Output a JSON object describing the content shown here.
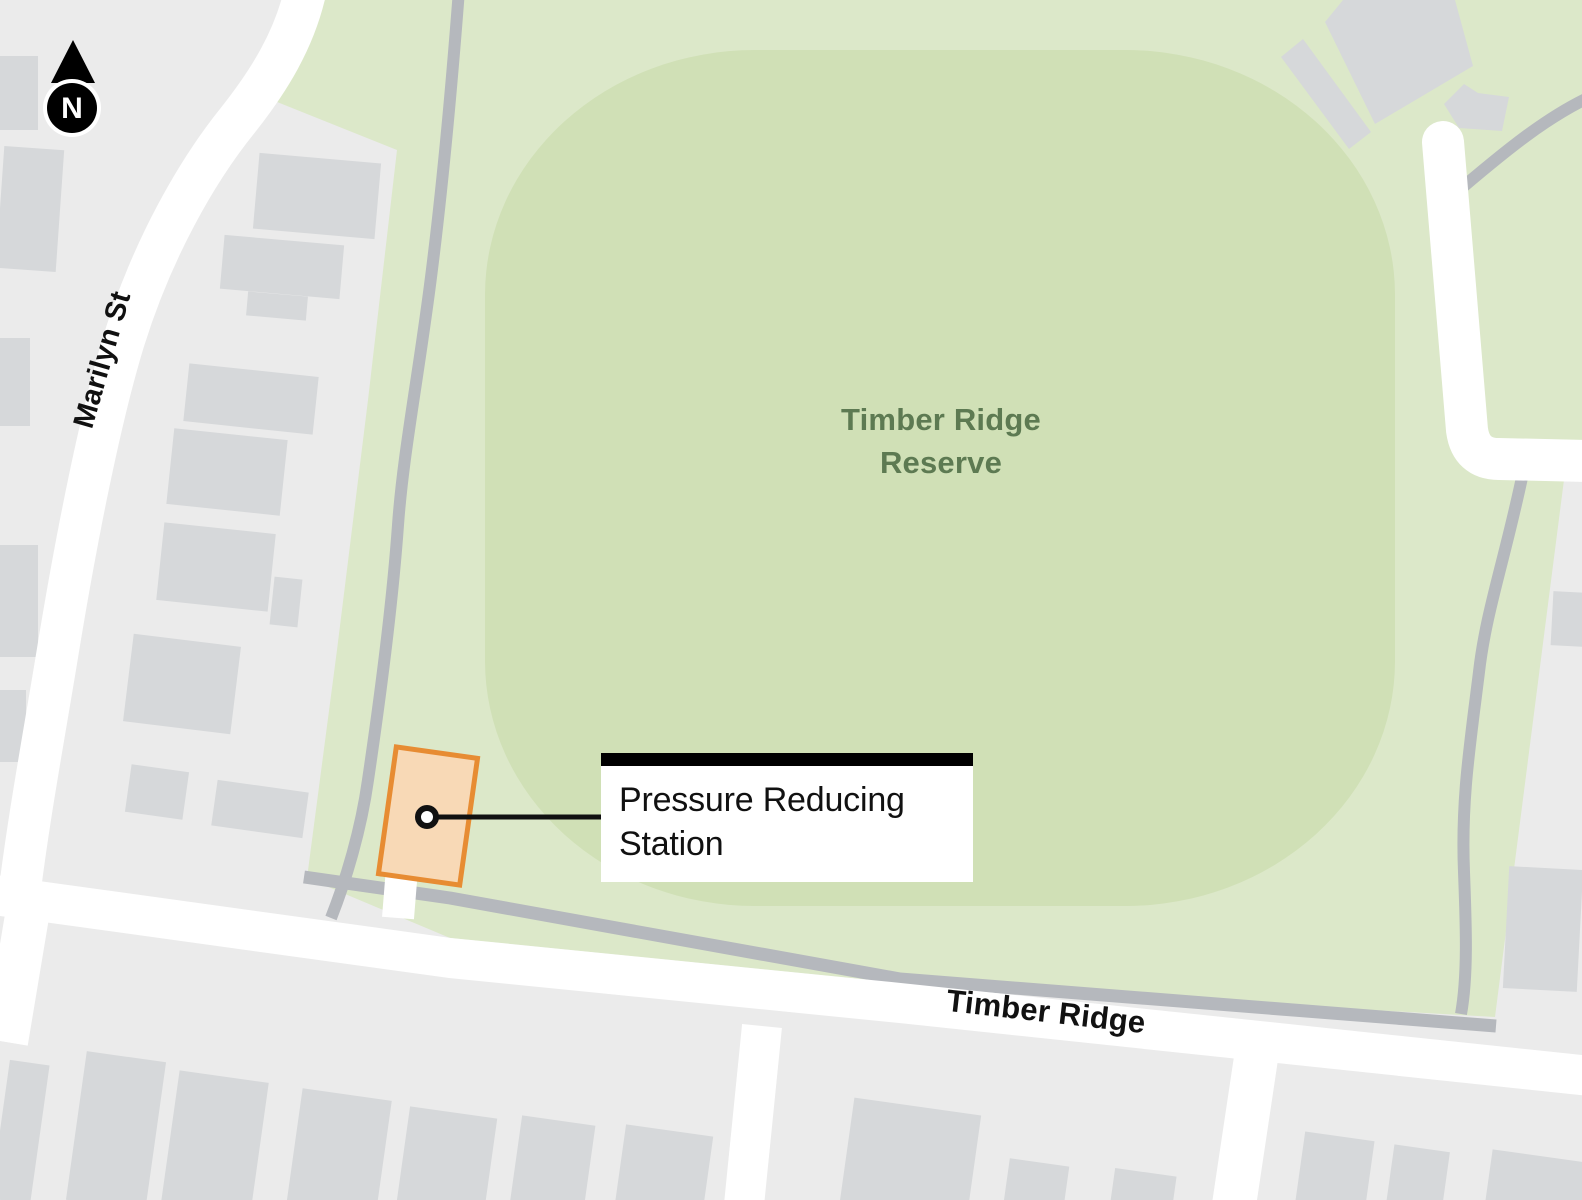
{
  "map": {
    "compass": {
      "label": "N"
    },
    "streets": {
      "marilyn": {
        "label": "Marilyn St"
      },
      "timber_ridge": {
        "label": "Timber Ridge"
      }
    },
    "reserve": {
      "line1": "Timber Ridge",
      "line2": "Reserve"
    },
    "callout": {
      "label": "Pressure Reducing Station"
    },
    "colors": {
      "background": "#ebebeb",
      "building": "#d6d8da",
      "park": "#dce8c9",
      "park_oval": "#d0e0b6",
      "road": "#ffffff",
      "path": "#b5b8bd",
      "station_fill": "#f8d9b6",
      "station_stroke": "#e78c33",
      "reserve_text": "#5d7a52",
      "ink": "#111111"
    }
  }
}
